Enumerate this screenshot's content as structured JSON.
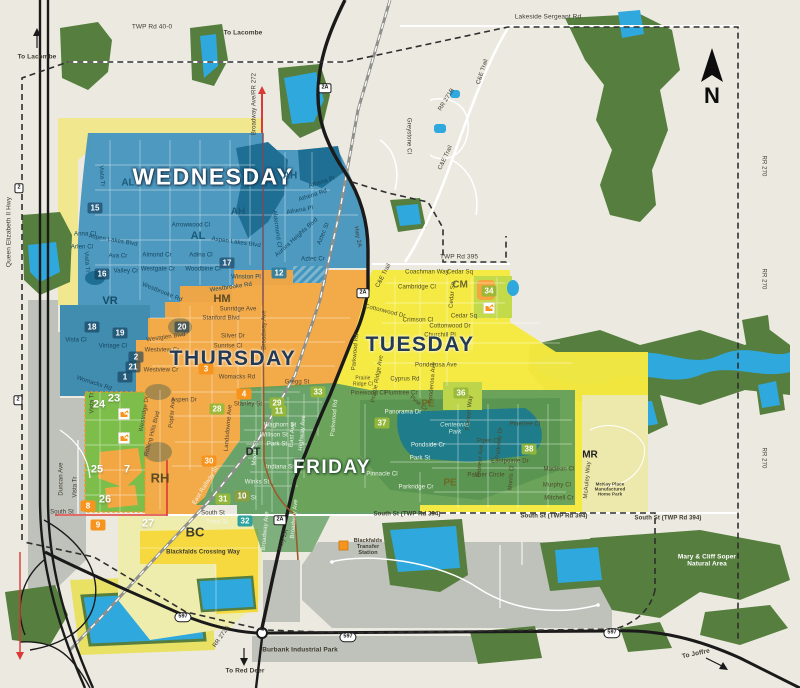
{
  "background": "#ECEAE0",
  "compass": {
    "label": "N"
  },
  "day_zones": [
    {
      "name": "WEDNESDAY",
      "fill": "#4495BD",
      "text_color": "#FFFFFF",
      "glow": "dark",
      "x": 213,
      "y": 177,
      "size": 23
    },
    {
      "name": "THURSDAY",
      "fill": "#F2A743",
      "text_color": "#243953",
      "glow": "light",
      "x": 233,
      "y": 359,
      "size": 21
    },
    {
      "name": "TUESDAY",
      "fill": "#F5E93E",
      "text_color": "#243953",
      "glow": "light",
      "x": 420,
      "y": 345,
      "size": 21
    },
    {
      "name": "FRIDAY",
      "fill": "#5B9B5C",
      "text_color": "#FFFFFF",
      "glow": "green",
      "x": 332,
      "y": 468,
      "size": 19
    }
  ],
  "neighborhoods": [
    {
      "code": "AH",
      "x": 290,
      "y": 176,
      "color": "#1B5A7A",
      "s": 10
    },
    {
      "code": "AH",
      "x": 238,
      "y": 212,
      "color": "#1B5A7A",
      "s": 10
    },
    {
      "code": "AL",
      "x": 128,
      "y": 183,
      "color": "#1B5A7A",
      "s": 10
    },
    {
      "code": "AL",
      "x": 198,
      "y": 236,
      "color": "#1B5A7A",
      "s": 11
    },
    {
      "code": "VR",
      "x": 110,
      "y": 301,
      "color": "#164C66",
      "s": 11
    },
    {
      "code": "HM",
      "x": 222,
      "y": 299,
      "color": "#5E4A20",
      "s": 11
    },
    {
      "code": "RH",
      "x": 160,
      "y": 478,
      "color": "#5E4A20",
      "s": 13
    },
    {
      "code": "DT",
      "x": 253,
      "y": 452,
      "color": "#1F2F23",
      "s": 11
    },
    {
      "code": "BC",
      "x": 195,
      "y": 532,
      "color": "#3A3A30",
      "s": 13
    },
    {
      "code": "CM",
      "x": 460,
      "y": 285,
      "color": "#6C6A23",
      "s": 10
    },
    {
      "code": "PE",
      "x": 428,
      "y": 404,
      "color": "#6C6A23",
      "s": 10
    },
    {
      "code": "PE",
      "x": 450,
      "y": 483,
      "color": "#6C6A23",
      "s": 10
    },
    {
      "code": "MR",
      "x": 590,
      "y": 455,
      "color": "#1F1F1F",
      "s": 10
    }
  ],
  "zone_numbers": [
    {
      "n": 15,
      "x": 95,
      "y": 208,
      "v": "dark"
    },
    {
      "n": 16,
      "x": 102,
      "y": 274,
      "v": "dark"
    },
    {
      "n": 17,
      "x": 227,
      "y": 263,
      "v": "dark"
    },
    {
      "n": 12,
      "x": 279,
      "y": 273,
      "v": "teal"
    },
    {
      "n": 18,
      "x": 92,
      "y": 327,
      "v": "dark"
    },
    {
      "n": 19,
      "x": 120,
      "y": 333,
      "v": "dark"
    },
    {
      "n": 20,
      "x": 182,
      "y": 327,
      "v": "dark"
    },
    {
      "n": 2,
      "x": 136,
      "y": 357,
      "v": "dark"
    },
    {
      "n": 21,
      "x": 133,
      "y": 367,
      "v": "dark"
    },
    {
      "n": 1,
      "x": 125,
      "y": 377,
      "v": "dark"
    },
    {
      "n": 3,
      "x": 206,
      "y": 369,
      "v": "orange"
    },
    {
      "n": 4,
      "x": 244,
      "y": 394,
      "v": "orange"
    },
    {
      "n": 28,
      "x": 217,
      "y": 409,
      "v": "green"
    },
    {
      "n": 23,
      "x": 114,
      "y": 398,
      "v": "plain"
    },
    {
      "n": 24,
      "x": 99,
      "y": 404,
      "v": "plain"
    },
    {
      "n": 25,
      "x": 97,
      "y": 469,
      "v": "plain"
    },
    {
      "n": 7,
      "x": 127,
      "y": 469,
      "v": "plain"
    },
    {
      "n": 26,
      "x": 105,
      "y": 499,
      "v": "plain"
    },
    {
      "n": 8,
      "x": 88,
      "y": 506,
      "v": "orange"
    },
    {
      "n": 9,
      "x": 98,
      "y": 525,
      "v": "orange"
    },
    {
      "n": 27,
      "x": 148,
      "y": 523,
      "v": "plain"
    },
    {
      "n": 30,
      "x": 209,
      "y": 461,
      "v": "orange"
    },
    {
      "n": 31,
      "x": 223,
      "y": 499,
      "v": "green"
    },
    {
      "n": 10,
      "x": 242,
      "y": 496,
      "v": "olive"
    },
    {
      "n": 32,
      "x": 245,
      "y": 521,
      "v": "tealsq"
    },
    {
      "n": 29,
      "x": 277,
      "y": 403,
      "v": "green"
    },
    {
      "n": 11,
      "x": 279,
      "y": 411,
      "v": "green"
    },
    {
      "n": 33,
      "x": 318,
      "y": 392,
      "v": "green"
    },
    {
      "n": 34,
      "x": 489,
      "y": 291,
      "v": "green"
    },
    {
      "n": 36,
      "x": 461,
      "y": 393,
      "v": "green"
    },
    {
      "n": 37,
      "x": 382,
      "y": 423,
      "v": "green"
    },
    {
      "n": 38,
      "x": 529,
      "y": 449,
      "v": "green"
    }
  ],
  "shields": [
    {
      "label": "2",
      "x": 19,
      "y": 188,
      "shape": "rect"
    },
    {
      "label": "2",
      "x": 18,
      "y": 400,
      "shape": "rect"
    },
    {
      "label": "2A",
      "x": 325,
      "y": 88,
      "shape": "rect"
    },
    {
      "label": "2A",
      "x": 363,
      "y": 293,
      "shape": "rect"
    },
    {
      "label": "2A",
      "x": 280,
      "y": 520,
      "shape": "rect"
    },
    {
      "label": "597",
      "x": 183,
      "y": 617,
      "shape": "pill"
    },
    {
      "label": "597",
      "x": 348,
      "y": 637,
      "shape": "pill"
    },
    {
      "label": "597",
      "x": 612,
      "y": 633,
      "shape": "pill"
    }
  ],
  "labels": [
    {
      "t": "TWP Rd 40-0",
      "x": 152,
      "y": 27,
      "s": 6.5
    },
    {
      "t": "To Lacombe",
      "x": 37,
      "y": 57,
      "s": 6.5,
      "b": 1,
      "n": "direction-label"
    },
    {
      "t": "To Lacombe",
      "x": 243,
      "y": 33,
      "s": 6.5,
      "b": 1,
      "n": "direction-label"
    },
    {
      "t": "Broadway Ave/RR 272",
      "x": 255,
      "y": 104,
      "r": -90,
      "s": 6
    },
    {
      "t": "Lakeside Sergeant Rd",
      "x": 548,
      "y": 17,
      "s": 6.5
    },
    {
      "t": "C&E Trail",
      "x": 483,
      "y": 72,
      "r": -72,
      "s": 6
    },
    {
      "t": "RR 271B",
      "x": 447,
      "y": 100,
      "r": -58,
      "s": 6
    },
    {
      "t": "Greystone Cl",
      "x": 408,
      "y": 136,
      "r": 90,
      "s": 6
    },
    {
      "t": "C&E Trail",
      "x": 446,
      "y": 158,
      "r": -65,
      "s": 6
    },
    {
      "t": "Hwy 2A",
      "x": 357,
      "y": 237,
      "r": 80,
      "s": 6
    },
    {
      "t": "C&E Trail",
      "x": 384,
      "y": 276,
      "r": -62,
      "s": 6
    },
    {
      "t": "TWP Rd 395",
      "x": 459,
      "y": 257,
      "s": 6.5
    },
    {
      "t": "Queen Elizabeth II Hwy",
      "x": 9,
      "y": 232,
      "r": -90,
      "s": 6.5
    },
    {
      "t": "RR 270",
      "x": 763,
      "y": 166,
      "r": 90,
      "s": 6
    },
    {
      "t": "RR 270",
      "x": 763,
      "y": 279,
      "r": 90,
      "s": 6
    },
    {
      "t": "RR 270",
      "x": 763,
      "y": 458,
      "r": 90,
      "s": 6
    },
    {
      "t": "Vista Tr",
      "x": 101,
      "y": 176,
      "r": 85,
      "v": "b",
      "s": 6
    },
    {
      "t": "Anna Cl",
      "x": 85,
      "y": 235,
      "v": "b",
      "s": 6
    },
    {
      "t": "Aspen Lakes Blvd",
      "x": 113,
      "y": 241,
      "r": 10,
      "v": "b",
      "s": 6
    },
    {
      "t": "Arlen Cl",
      "x": 82,
      "y": 248,
      "v": "b",
      "s": 6
    },
    {
      "t": "Ava Cr",
      "x": 118,
      "y": 257,
      "v": "b",
      "s": 6
    },
    {
      "t": "Valley Cr",
      "x": 126,
      "y": 272,
      "v": "b",
      "s": 6
    },
    {
      "t": "Westgate Cr",
      "x": 158,
      "y": 270,
      "v": "b",
      "s": 6
    },
    {
      "t": "Almond Cr",
      "x": 157,
      "y": 256,
      "v": "b",
      "s": 6
    },
    {
      "t": "Adina Cl",
      "x": 201,
      "y": 256,
      "v": "b",
      "s": 6
    },
    {
      "t": "Woodbine Cl",
      "x": 203,
      "y": 270,
      "v": "b",
      "s": 6
    },
    {
      "t": "Aspen Lakes Blvd",
      "x": 236,
      "y": 243,
      "r": 8,
      "v": "b",
      "s": 6
    },
    {
      "t": "Arrowwood Cl",
      "x": 191,
      "y": 226,
      "v": "b",
      "s": 6
    },
    {
      "t": "Westbrooke Rd",
      "x": 231,
      "y": 288,
      "r": -8,
      "v": "b",
      "s": 6
    },
    {
      "t": "Westbrooke Rd",
      "x": 162,
      "y": 293,
      "r": 22,
      "v": "b",
      "s": 6
    },
    {
      "t": "Winston Pl",
      "x": 246,
      "y": 278,
      "v": "b",
      "s": 6
    },
    {
      "t": "Vista Tr",
      "x": 86,
      "y": 262,
      "r": 85,
      "v": "b",
      "s": 6
    },
    {
      "t": "Vista Cl",
      "x": 76,
      "y": 341,
      "v": "b",
      "s": 6
    },
    {
      "t": "Vintage Cl",
      "x": 113,
      "y": 347,
      "v": "b",
      "s": 6
    },
    {
      "t": "Athena Pl",
      "x": 322,
      "y": 183,
      "r": -18,
      "v": "b",
      "s": 6
    },
    {
      "t": "Athena Rd",
      "x": 313,
      "y": 196,
      "r": -18,
      "v": "b",
      "s": 6
    },
    {
      "t": "Athena Pl",
      "x": 300,
      "y": 211,
      "r": -10,
      "v": "b",
      "s": 6
    },
    {
      "t": "Aurora Heights Blvd",
      "x": 297,
      "y": 238,
      "r": -42,
      "v": "b",
      "s": 6
    },
    {
      "t": "Aztec St",
      "x": 324,
      "y": 234,
      "r": -68,
      "v": "b",
      "s": 6
    },
    {
      "t": "Aztec Cr",
      "x": 313,
      "y": 260,
      "v": "b",
      "s": 6
    },
    {
      "t": "Aldermond Cl",
      "x": 276,
      "y": 229,
      "r": 82,
      "v": "b",
      "s": 6
    },
    {
      "t": "Womacks Rd",
      "x": 94,
      "y": 384,
      "r": 18,
      "v": "b",
      "s": 6
    },
    {
      "t": "Sunridge Ave",
      "x": 238,
      "y": 310,
      "v": "o",
      "s": 6
    },
    {
      "t": "Stanford Blvd",
      "x": 221,
      "y": 319,
      "v": "o",
      "s": 6
    },
    {
      "t": "Silver Dr",
      "x": 233,
      "y": 337,
      "v": "o",
      "s": 6
    },
    {
      "t": "Sunrise Cl",
      "x": 228,
      "y": 347,
      "v": "o",
      "s": 6
    },
    {
      "t": "Westglen Blvd",
      "x": 166,
      "y": 338,
      "r": -8,
      "v": "o",
      "s": 6
    },
    {
      "t": "Westview Cr",
      "x": 162,
      "y": 351,
      "v": "o",
      "s": 6
    },
    {
      "t": "Westview Cr",
      "x": 161,
      "y": 371,
      "v": "o",
      "s": 6
    },
    {
      "t": "Womacks Rd",
      "x": 237,
      "y": 378,
      "v": "o",
      "s": 6
    },
    {
      "t": "Broadway Ave",
      "x": 265,
      "y": 330,
      "r": -90,
      "v": "o",
      "s": 6
    },
    {
      "t": "Gregg St",
      "x": 297,
      "y": 383,
      "v": "o",
      "s": 6
    },
    {
      "t": "Stanley St",
      "x": 248,
      "y": 405,
      "v": "o",
      "s": 6
    },
    {
      "t": "Aspen Dr",
      "x": 184,
      "y": 401,
      "v": "o",
      "s": 6
    },
    {
      "t": "Poplar Ave",
      "x": 173,
      "y": 413,
      "r": -85,
      "v": "o",
      "s": 6
    },
    {
      "t": "Westridge Dr",
      "x": 145,
      "y": 414,
      "r": -80,
      "v": "o",
      "s": 6
    },
    {
      "t": "Landsdowne Ave",
      "x": 229,
      "y": 428,
      "r": -85,
      "v": "o",
      "s": 6
    },
    {
      "t": "Rolling Hills Blvd",
      "x": 153,
      "y": 434,
      "r": -75,
      "v": "o",
      "s": 6
    },
    {
      "t": "Waghorn St",
      "x": 280,
      "y": 426,
      "v": "gw",
      "s": 6
    },
    {
      "t": "Willson St",
      "x": 274,
      "y": 436,
      "v": "gw",
      "s": 6
    },
    {
      "t": "Park St",
      "x": 277,
      "y": 445,
      "v": "gw",
      "s": 6
    },
    {
      "t": "Indiana St",
      "x": 280,
      "y": 468,
      "v": "gw",
      "s": 6
    },
    {
      "t": "Winks St",
      "x": 257,
      "y": 483,
      "v": "gw",
      "s": 6
    },
    {
      "t": "Shull St",
      "x": 246,
      "y": 499,
      "v": "gw",
      "s": 6
    },
    {
      "t": "East Railway St",
      "x": 206,
      "y": 486,
      "r": -58,
      "v": "gw",
      "s": 6
    },
    {
      "t": "East Ave",
      "x": 293,
      "y": 435,
      "r": -85,
      "v": "gw",
      "s": 6
    },
    {
      "t": "Highway Ave",
      "x": 303,
      "y": 433,
      "r": -85,
      "v": "gw",
      "s": 6
    },
    {
      "t": "Moore St",
      "x": 256,
      "y": 453,
      "r": -85,
      "v": "gw",
      "s": 6
    },
    {
      "t": "Broadway Ave",
      "x": 295,
      "y": 519,
      "r": -85,
      "v": "gw",
      "s": 6
    },
    {
      "t": "Trout St",
      "x": 217,
      "y": 523,
      "v": "gw",
      "s": 6
    },
    {
      "t": "Broadway Ave",
      "x": 266,
      "y": 531,
      "r": -85,
      "v": "gw",
      "s": 6
    },
    {
      "t": "Panorama Dr",
      "x": 403,
      "y": 413,
      "v": "gw",
      "s": 6
    },
    {
      "t": "Pondside Cr",
      "x": 428,
      "y": 446,
      "v": "gw",
      "s": 6
    },
    {
      "t": "Park St",
      "x": 420,
      "y": 459,
      "v": "gw",
      "s": 6
    },
    {
      "t": "Parkridge Cr",
      "x": 416,
      "y": 488,
      "v": "gw",
      "s": 6
    },
    {
      "t": "Pinnacle Cl",
      "x": 382,
      "y": 475,
      "v": "gw",
      "s": 6
    },
    {
      "t": "Parkwood Rd",
      "x": 335,
      "y": 418,
      "r": -85,
      "v": "gw",
      "s": 6
    },
    {
      "t": "Centennial\nPark",
      "x": 455,
      "y": 429,
      "v": "p",
      "s": 6,
      "n": "park-label"
    },
    {
      "t": "South St",
      "x": 62,
      "y": 513,
      "s": 6
    },
    {
      "t": "South St",
      "x": 213,
      "y": 514,
      "s": 6
    },
    {
      "t": "South St (TWP Rd 394)",
      "x": 407,
      "y": 515,
      "s": 6,
      "b": 1
    },
    {
      "t": "South St (TWP Rd 394)",
      "x": 554,
      "y": 517,
      "s": 6,
      "b": 1
    },
    {
      "t": "South St (TWP Rd 394)",
      "x": 668,
      "y": 519,
      "s": 6,
      "b": 1
    },
    {
      "t": "Duncan Ave",
      "x": 62,
      "y": 479,
      "r": -90,
      "s": 6
    },
    {
      "t": "Vista Tr",
      "x": 93,
      "y": 403,
      "r": -90,
      "s": 6
    },
    {
      "t": "Vista Tr",
      "x": 76,
      "y": 487,
      "r": -90,
      "s": 6
    },
    {
      "t": "Coachman Way",
      "x": 427,
      "y": 273,
      "v": "y",
      "s": 6
    },
    {
      "t": "Cedar Sq",
      "x": 460,
      "y": 273,
      "v": "y",
      "s": 6
    },
    {
      "t": "Cambridge Cl",
      "x": 417,
      "y": 288,
      "v": "y",
      "s": 6
    },
    {
      "t": "Crimson Cl",
      "x": 418,
      "y": 321,
      "v": "y",
      "s": 6
    },
    {
      "t": "Cedar Sq",
      "x": 464,
      "y": 317,
      "v": "y",
      "s": 6
    },
    {
      "t": "Cedar Sq",
      "x": 453,
      "y": 295,
      "r": -85,
      "v": "y",
      "s": 6
    },
    {
      "t": "Cottonwood Dr",
      "x": 385,
      "y": 312,
      "r": 14,
      "v": "y",
      "s": 6
    },
    {
      "t": "Cottonwood Dr",
      "x": 450,
      "y": 327,
      "v": "y",
      "s": 6
    },
    {
      "t": "Churchill Pl",
      "x": 440,
      "y": 336,
      "v": "y",
      "s": 6
    },
    {
      "t": "Ponderosa Ave",
      "x": 436,
      "y": 366,
      "v": "y",
      "s": 6
    },
    {
      "t": "Ponderosa Ave",
      "x": 433,
      "y": 383,
      "r": -85,
      "v": "y",
      "s": 6
    },
    {
      "t": "Cyprus Rd",
      "x": 405,
      "y": 380,
      "v": "y",
      "s": 6
    },
    {
      "t": "Plumtree Cr",
      "x": 401,
      "y": 394,
      "v": "y",
      "s": 6
    },
    {
      "t": "Pinewood Cl",
      "x": 368,
      "y": 394,
      "v": "y",
      "s": 6
    },
    {
      "t": "Prairie Ridge Ave",
      "x": 378,
      "y": 379,
      "r": -80,
      "v": "y",
      "s": 6
    },
    {
      "t": "Prairie\nRidge Cl",
      "x": 363,
      "y": 382,
      "v": "y",
      "s": 5
    },
    {
      "t": "Parkwood Rd",
      "x": 356,
      "y": 352,
      "r": -85,
      "v": "y",
      "s": 6
    },
    {
      "t": "Pine Cr",
      "x": 418,
      "y": 404,
      "r": 40,
      "v": "y",
      "s": 6
    },
    {
      "t": "Pioneer Way",
      "x": 470,
      "y": 413,
      "r": -85,
      "v": "y",
      "s": 6
    },
    {
      "t": "Pioneer Ave",
      "x": 481,
      "y": 461,
      "r": -85,
      "v": "y",
      "s": 6
    },
    {
      "t": "Pinetree Cl",
      "x": 525,
      "y": 425,
      "v": "y",
      "s": 6
    },
    {
      "t": "Piper Cl",
      "x": 488,
      "y": 442,
      "v": "y",
      "s": 6
    },
    {
      "t": "Parkway Dr",
      "x": 500,
      "y": 443,
      "r": -85,
      "v": "y",
      "s": 6
    },
    {
      "t": "Eastpointe Dr",
      "x": 510,
      "y": 462,
      "v": "y",
      "s": 6
    },
    {
      "t": "Palmer Circle",
      "x": 486,
      "y": 476,
      "v": "y",
      "s": 6
    },
    {
      "t": "Morris Cl",
      "x": 512,
      "y": 478,
      "r": -85,
      "v": "y",
      "s": 6
    },
    {
      "t": "Maclean Cl",
      "x": 559,
      "y": 470,
      "v": "y",
      "s": 6
    },
    {
      "t": "Murphy Cl",
      "x": 557,
      "y": 486,
      "v": "y",
      "s": 6
    },
    {
      "t": "Mitchell Cr",
      "x": 559,
      "y": 499,
      "v": "y",
      "s": 6
    },
    {
      "t": "McAuley Way",
      "x": 588,
      "y": 480,
      "r": -85,
      "v": "y",
      "s": 6
    },
    {
      "t": "McKay Place\nManufactured\nHome Park",
      "x": 610,
      "y": 489,
      "s": 4.5,
      "b": 1,
      "n": "area-label"
    },
    {
      "t": "Blackfalds Crossing Way",
      "x": 203,
      "y": 553,
      "s": 6,
      "b": 1
    },
    {
      "t": "Blackfalds\nTransfer\nStation",
      "x": 368,
      "y": 547,
      "s": 5.5,
      "b": 1,
      "n": "poi-label"
    },
    {
      "t": "Hwy 2A",
      "x": 284,
      "y": 540,
      "r": -72,
      "s": 6
    },
    {
      "t": "Burbank Industrial Park",
      "x": 300,
      "y": 650,
      "s": 6.5,
      "b": 1,
      "n": "area-label"
    },
    {
      "t": "To Red Deer",
      "x": 245,
      "y": 671,
      "s": 6.5,
      "b": 1,
      "n": "direction-label"
    },
    {
      "t": "RR 272A",
      "x": 222,
      "y": 637,
      "r": -55,
      "s": 6
    },
    {
      "t": "To Joffre",
      "x": 696,
      "y": 654,
      "r": -12,
      "s": 6.5,
      "b": 1,
      "n": "direction-label"
    },
    {
      "t": "Mary & Cliff Soper\nNatural Area",
      "x": 707,
      "y": 561,
      "v": "w",
      "s": 6.5,
      "n": "natural-area-label"
    }
  ]
}
